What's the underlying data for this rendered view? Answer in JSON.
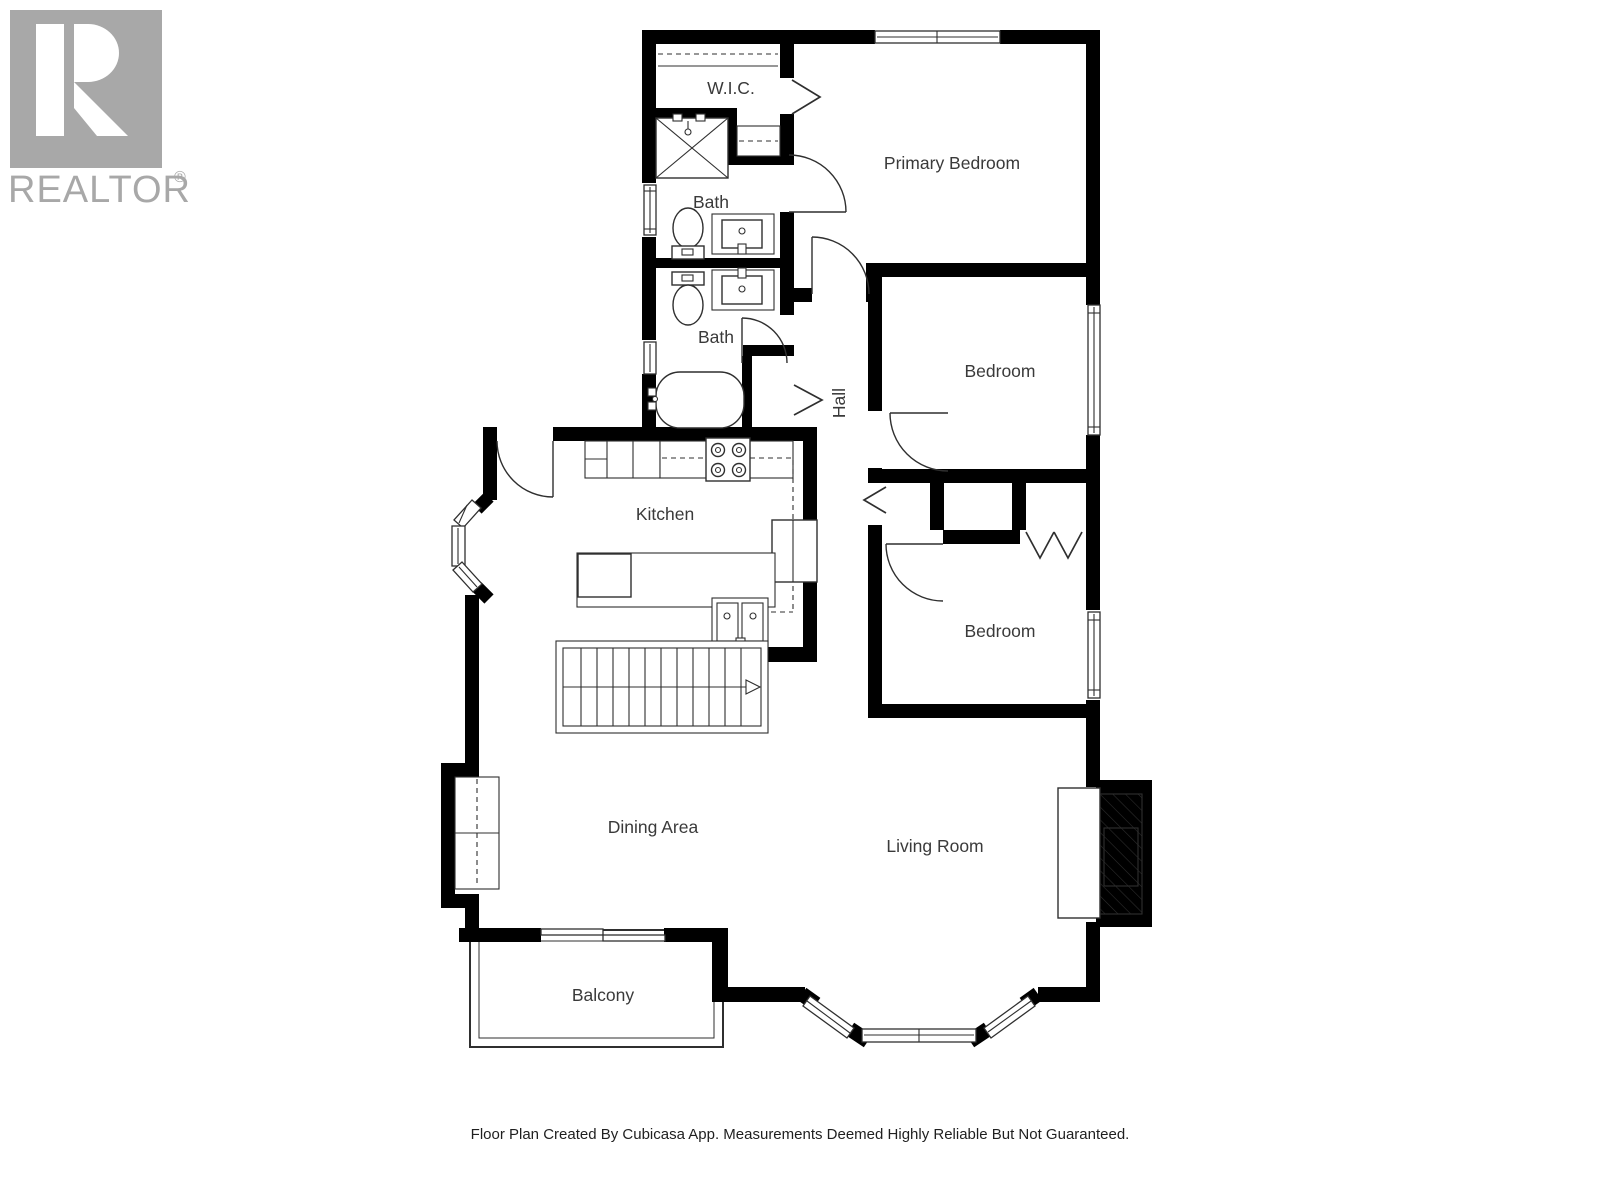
{
  "watermark": {
    "brand": "REALTOR",
    "registered": "®"
  },
  "rooms": {
    "wic": "W.I.C.",
    "bath_upper": "Bath",
    "bath_lower": "Bath",
    "hall": "Hall",
    "primary_bedroom": "Primary Bedroom",
    "bedroom_middle": "Bedroom",
    "bedroom_lower": "Bedroom",
    "kitchen": "Kitchen",
    "dining_area": "Dining Area",
    "living_room": "Living Room",
    "balcony": "Balcony"
  },
  "footer": {
    "disclaimer": "Floor Plan Created By Cubicasa App. Measurements Deemed Highly Reliable But Not Guaranteed."
  },
  "icons": [
    "shower-icon",
    "toilet-icon",
    "sink-icon",
    "bathtub-icon",
    "stove-icon",
    "kitchen-sink-icon",
    "refrigerator-icon",
    "stairs-icon",
    "fireplace-icon",
    "door-arc-icon",
    "door-chevron-icon",
    "bifold-door-icon",
    "window-icon",
    "sliding-door-icon",
    "closet-rod-icon",
    "bay-window-icon"
  ],
  "colors": {
    "wall": "#000000",
    "line": "#2f2f2f",
    "label": "#3a3a3a",
    "watermark": "#a8a8a8",
    "background": "#ffffff"
  }
}
